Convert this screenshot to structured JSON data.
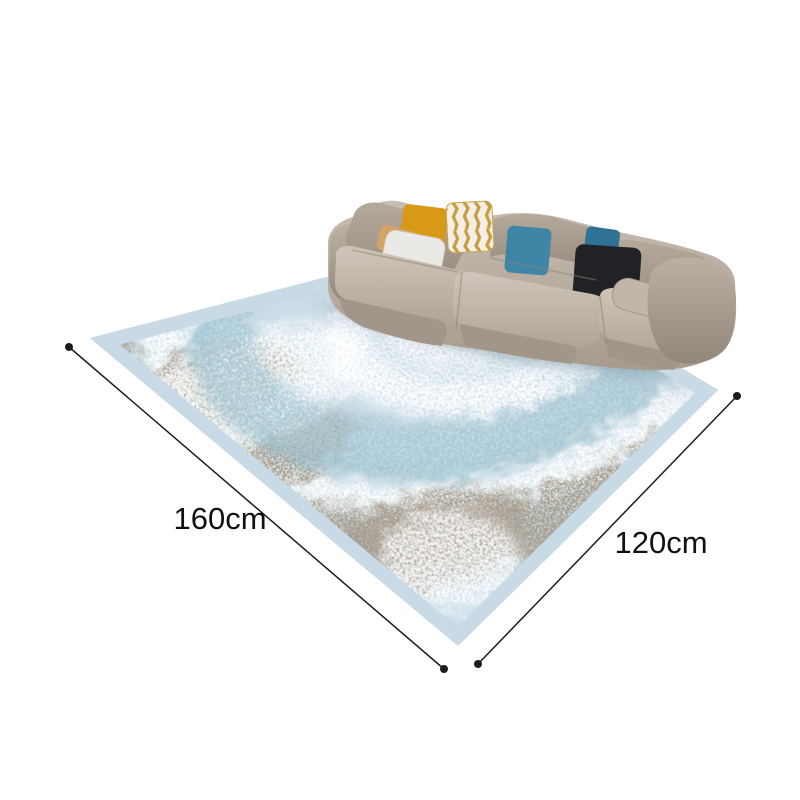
{
  "annotations": {
    "length_label": "160cm",
    "width_label": "120cm",
    "line_color": "#1c1c1c",
    "label_color": "#111111"
  },
  "palette": {
    "background": "#ffffff",
    "rug_base": "#cddee8",
    "rug_border": "#c8dae5",
    "rug_blue_band": "#a7c9d5",
    "rug_blue_deep": "#8fb9c8",
    "rug_white": "#ffffff",
    "rug_grey": "#a59c8d",
    "sofa_fabric_light": "#cbc1b5",
    "sofa_fabric_mid": "#b2a699",
    "sofa_fabric_dark": "#978b7e",
    "pillow_yellow": "#d89a16",
    "pillow_gold_stripe": "#c69e3f",
    "pillow_gold_base": "#f3efe6",
    "pillow_camel": "#d4a467",
    "pillow_white": "#ebe9e5",
    "pillow_blue": "#3f85a6",
    "pillow_teal": "#2f7394",
    "pillow_black": "#202225",
    "pillow_bolster": "#c2b6a8"
  }
}
